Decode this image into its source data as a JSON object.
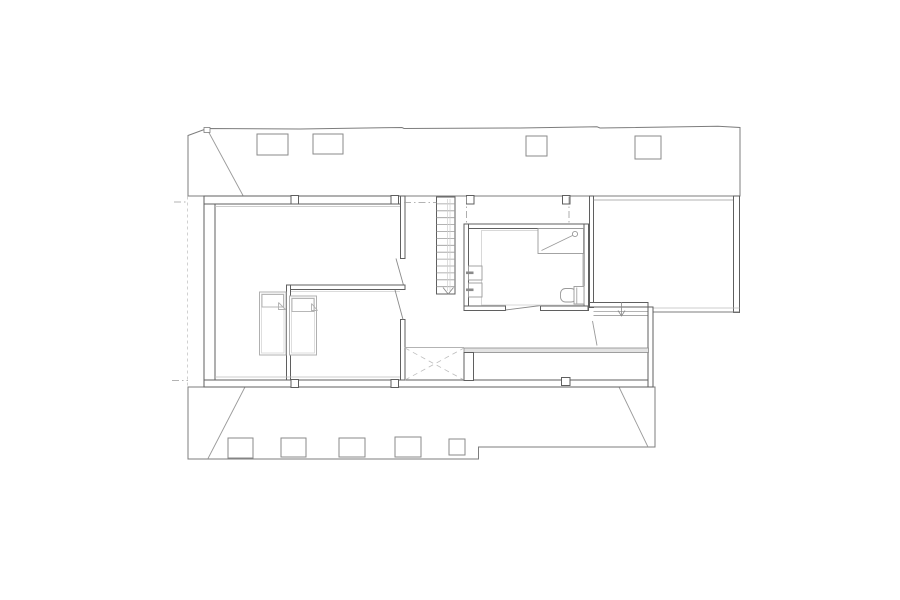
{
  "palette": {
    "wall": "#5f5f5f",
    "edge": "#7d7d7d",
    "line": "#9a9a9a",
    "mid": "#8a8a8a",
    "light": "#bdbdbd",
    "xlight": "#cfcfcf",
    "bed": "#b0b0b0",
    "bedin": "#d6d6d6",
    "dashln": "#c6c6c6",
    "glass": "#e3e3e3",
    "white": "#ffffff"
  },
  "canvas": {
    "width": 900,
    "height": 600,
    "background": "#ffffff"
  },
  "dash": {
    "dot": "3,3",
    "centerline": "7,3,1.5,3",
    "void": "5,4"
  },
  "shapes": [
    {
      "type": "poly",
      "name": "upper-roof-outline",
      "points": "188,135.5 207,128.5 300,129 402,127.5 404,128.5 520,128 597,126.8 600,128 718,126.3 740,127.5 740,196 188,196",
      "stroke": "edge",
      "fill": "white",
      "sw": 1
    },
    {
      "type": "line",
      "name": "upper-roof-hip",
      "x1": 207,
      "y1": 129,
      "x2": 243,
      "y2": 195.5,
      "stroke": "line",
      "sw": 0.9
    },
    {
      "type": "rect",
      "name": "upper-roof-step-notch",
      "x": 204,
      "y": 127.5,
      "w": 6,
      "h": 5,
      "stroke": "edge",
      "fill": "white",
      "sw": 0.8
    },
    {
      "type": "rect",
      "name": "skylight-upper-1",
      "x": 257,
      "y": 134,
      "w": 31,
      "h": 21,
      "stroke": "mid",
      "fill": "white",
      "sw": 1
    },
    {
      "type": "rect",
      "name": "skylight-upper-2",
      "x": 313,
      "y": 134,
      "w": 30,
      "h": 20,
      "stroke": "mid",
      "fill": "white",
      "sw": 1
    },
    {
      "type": "rect",
      "name": "skylight-upper-3",
      "x": 526,
      "y": 136,
      "w": 21,
      "h": 20,
      "stroke": "mid",
      "fill": "white",
      "sw": 1
    },
    {
      "type": "rect",
      "name": "skylight-upper-4",
      "x": 635,
      "y": 136,
      "w": 26,
      "h": 23,
      "stroke": "mid",
      "fill": "white",
      "sw": 1
    },
    {
      "type": "poly",
      "name": "lower-roof-outline",
      "points": "188,387 188,459 478.5,459 478.5,447 655,447 655,387",
      "stroke": "edge",
      "fill": "white",
      "sw": 1
    },
    {
      "type": "line",
      "name": "lower-roof-hip-left",
      "x1": 208,
      "y1": 458.5,
      "x2": 245,
      "y2": 387,
      "stroke": "line",
      "sw": 0.9
    },
    {
      "type": "line",
      "name": "lower-roof-hip-right",
      "x1": 619,
      "y1": 387,
      "x2": 648,
      "y2": 447,
      "stroke": "line",
      "sw": 0.9
    },
    {
      "type": "rect",
      "name": "skylight-lower-1",
      "x": 228,
      "y": 438,
      "w": 25,
      "h": 20,
      "stroke": "mid",
      "fill": "white",
      "sw": 1
    },
    {
      "type": "rect",
      "name": "skylight-lower-2",
      "x": 281,
      "y": 438,
      "w": 25,
      "h": 19,
      "stroke": "mid",
      "fill": "white",
      "sw": 1
    },
    {
      "type": "rect",
      "name": "skylight-lower-3",
      "x": 339,
      "y": 438,
      "w": 26,
      "h": 19,
      "stroke": "mid",
      "fill": "white",
      "sw": 1
    },
    {
      "type": "rect",
      "name": "skylight-lower-4",
      "x": 395,
      "y": 437,
      "w": 26,
      "h": 20,
      "stroke": "mid",
      "fill": "white",
      "sw": 1
    },
    {
      "type": "rect",
      "name": "skylight-lower-5",
      "x": 449,
      "y": 439,
      "w": 16,
      "h": 16,
      "stroke": "mid",
      "fill": "white",
      "sw": 1
    },
    {
      "type": "line",
      "name": "eave-projection-dashed",
      "x1": 187.5,
      "y1": 196.5,
      "x2": 187.5,
      "y2": 387,
      "stroke": "dashln",
      "sw": 0.8,
      "dash": "3,3"
    },
    {
      "type": "line",
      "name": "centerline-left-top",
      "x1": 174,
      "y1": 202,
      "x2": 188,
      "y2": 202,
      "stroke": "line",
      "sw": 0.8,
      "dash": "7,3,1.5,3"
    },
    {
      "type": "line",
      "name": "centerline-left-bottom",
      "x1": 172,
      "y1": 380.5,
      "x2": 188,
      "y2": 380.5,
      "stroke": "line",
      "sw": 0.8,
      "dash": "7,3,1.5,3"
    },
    {
      "type": "rect",
      "name": "left-exterior-wall",
      "x": 204,
      "y": 198.5,
      "w": 11,
      "h": 183,
      "stroke": "wall",
      "fill": "white",
      "sw": 1
    },
    {
      "type": "rect",
      "name": "top-exterior-wall",
      "x": 204,
      "y": 196,
      "w": 201,
      "h": 8,
      "stroke": "wall",
      "fill": "white",
      "sw": 1
    },
    {
      "type": "line",
      "name": "room1-top-finish-line",
      "x1": 215,
      "y1": 206.5,
      "x2": 400,
      "y2": 206.5,
      "stroke": "light",
      "sw": 0.8
    },
    {
      "type": "rect",
      "name": "room1-right-wall",
      "x": 400.5,
      "y": 196,
      "w": 4.5,
      "h": 62.5,
      "stroke": "wall",
      "fill": "white",
      "sw": 1
    },
    {
      "type": "line",
      "name": "room1-door-leaf",
      "x1": 396,
      "y1": 258.5,
      "x2": 404,
      "y2": 287,
      "stroke": "mid",
      "sw": 0.9
    },
    {
      "type": "rect",
      "name": "bedrooms-dividing-wall-horizontal",
      "x": 286.5,
      "y": 285,
      "w": 118.5,
      "h": 4.5,
      "stroke": "wall",
      "fill": "white",
      "sw": 1
    },
    {
      "type": "rect",
      "name": "bedrooms-dividing-wall-vertical",
      "x": 286.5,
      "y": 285,
      "w": 4,
      "h": 95.5,
      "stroke": "wall",
      "fill": "white",
      "sw": 1
    },
    {
      "type": "line",
      "name": "room2-top-finish-line",
      "x1": 291,
      "y1": 291.5,
      "x2": 400,
      "y2": 291.5,
      "stroke": "xlight",
      "sw": 0.8
    },
    {
      "type": "rect",
      "name": "room2-right-wall",
      "x": 400.5,
      "y": 319.5,
      "w": 4.5,
      "h": 60.5,
      "stroke": "wall",
      "fill": "white",
      "sw": 1
    },
    {
      "type": "line",
      "name": "room2-door-leaf",
      "x1": 395,
      "y1": 290,
      "x2": 403,
      "y2": 319.5,
      "stroke": "mid",
      "sw": 0.9
    },
    {
      "type": "line",
      "name": "rooms-bottom-finish-line",
      "x1": 215,
      "y1": 377,
      "x2": 400,
      "y2": 377,
      "stroke": "light",
      "sw": 0.8
    },
    {
      "type": "rect",
      "name": "bottom-exterior-wall",
      "x": 204,
      "y": 380,
      "w": 449,
      "h": 7,
      "stroke": "wall",
      "fill": "white",
      "sw": 1
    },
    {
      "type": "rect",
      "name": "column-post-top-1",
      "x": 291,
      "y": 195.5,
      "w": 7.5,
      "h": 8.5,
      "stroke": "wall",
      "fill": "white",
      "sw": 1
    },
    {
      "type": "rect",
      "name": "column-post-top-2",
      "x": 391,
      "y": 195.5,
      "w": 7.5,
      "h": 8.5,
      "stroke": "wall",
      "fill": "white",
      "sw": 1
    },
    {
      "type": "rect",
      "name": "column-post-skybox-left",
      "x": 466.5,
      "y": 195.5,
      "w": 7.5,
      "h": 8.5,
      "stroke": "wall",
      "fill": "white",
      "sw": 1
    },
    {
      "type": "rect",
      "name": "column-post-skybox-right",
      "x": 562.5,
      "y": 195.5,
      "w": 7.5,
      "h": 8.5,
      "stroke": "wall",
      "fill": "white",
      "sw": 1
    },
    {
      "type": "rect",
      "name": "column-post-bottom-1",
      "x": 291,
      "y": 379.5,
      "w": 7.5,
      "h": 8,
      "stroke": "wall",
      "fill": "white",
      "sw": 1
    },
    {
      "type": "rect",
      "name": "column-post-bottom-2",
      "x": 391,
      "y": 379.5,
      "w": 7.5,
      "h": 8,
      "stroke": "wall",
      "fill": "white",
      "sw": 1
    },
    {
      "type": "rect",
      "name": "column-post-bottom-3",
      "x": 561.5,
      "y": 377.5,
      "w": 8.5,
      "h": 8,
      "stroke": "wall",
      "fill": "white",
      "sw": 1
    },
    {
      "type": "rect",
      "name": "bed-1-outline",
      "x": 259.5,
      "y": 292,
      "w": 26.5,
      "h": 63,
      "stroke": "bed",
      "fill": "white",
      "sw": 1
    },
    {
      "type": "rect",
      "name": "bed-1-inner",
      "x": 261.5,
      "y": 294,
      "w": 22.5,
      "h": 59,
      "stroke": "bedin",
      "fill": "none",
      "sw": 0.8
    },
    {
      "type": "rect",
      "name": "bed-1-pillow",
      "x": 262,
      "y": 294.5,
      "w": 21.5,
      "h": 12.5,
      "stroke": "bed",
      "fill": "white",
      "sw": 0.9
    },
    {
      "type": "pline",
      "name": "bed-1-blanket-fold",
      "points": "278.5,302.5 278.5,309.5 285.5,309.5",
      "stroke": "bed",
      "fill": "none",
      "sw": 0.9
    },
    {
      "type": "line",
      "name": "bed-1-blanket-fold-diagonal",
      "x1": 278.5,
      "y1": 302.5,
      "x2": 285.5,
      "y2": 309.5,
      "stroke": "bed",
      "sw": 0.9
    },
    {
      "type": "rect",
      "name": "bed-2-outline",
      "x": 289.5,
      "y": 296,
      "w": 27,
      "h": 59,
      "stroke": "bed",
      "fill": "white",
      "sw": 1
    },
    {
      "type": "rect",
      "name": "bed-2-inner",
      "x": 291.5,
      "y": 298,
      "w": 23,
      "h": 55,
      "stroke": "bedin",
      "fill": "none",
      "sw": 0.8
    },
    {
      "type": "rect",
      "name": "bed-2-pillow",
      "x": 292,
      "y": 298.5,
      "w": 22,
      "h": 13,
      "stroke": "bed",
      "fill": "white",
      "sw": 0.9
    },
    {
      "type": "pline",
      "name": "bed-2-blanket-fold",
      "points": "311.5,303.5 311.5,310.5 317.5,310.5",
      "stroke": "bed",
      "fill": "none",
      "sw": 0.9
    },
    {
      "type": "line",
      "name": "bed-2-blanket-fold-diagonal",
      "x1": 311.5,
      "y1": 303.5,
      "x2": 317.5,
      "y2": 310.5,
      "stroke": "bed",
      "sw": 0.9
    },
    {
      "type": "rect",
      "name": "staircase-outline",
      "x": 436.5,
      "y": 197,
      "w": 18.5,
      "h": 97,
      "stroke": "wall",
      "fill": "white",
      "sw": 1
    },
    {
      "type": "hlines",
      "name": "staircase-treads",
      "x1": 436.5,
      "x2": 455,
      "y0": 203.9,
      "dy": 6.9,
      "n": 13,
      "stroke": "line",
      "sw": 0.8
    },
    {
      "type": "line",
      "name": "staircase-handrail-1",
      "x1": 447.5,
      "y1": 199,
      "x2": 447.5,
      "y2": 291,
      "stroke": "xlight",
      "sw": 0.7
    },
    {
      "type": "line",
      "name": "staircase-handrail-2",
      "x1": 450,
      "y1": 199,
      "x2": 450,
      "y2": 291,
      "stroke": "xlight",
      "sw": 0.7
    },
    {
      "type": "pline",
      "name": "staircase-down-arrow",
      "points": "443,287.5 448.2,294 453.5,287.5",
      "stroke": "mid",
      "fill": "none",
      "sw": 0.9
    },
    {
      "type": "line",
      "name": "centerline-hall",
      "x1": 404,
      "y1": 202.5,
      "x2": 436.5,
      "y2": 202.5,
      "stroke": "line",
      "sw": 0.8,
      "dash": "7,3,1.5,3"
    },
    {
      "type": "line",
      "name": "centerline-rooflight-left",
      "x1": 466.5,
      "y1": 196.5,
      "x2": 466.5,
      "y2": 224,
      "stroke": "line",
      "sw": 0.8,
      "dash": "7,3,1.5,3"
    },
    {
      "type": "line",
      "name": "centerline-rooflight-right",
      "x1": 569,
      "y1": 196.5,
      "x2": 569,
      "y2": 224,
      "stroke": "line",
      "sw": 0.8,
      "dash": "7,3,1.5,3"
    },
    {
      "type": "line",
      "name": "rooflight-bottom-edge",
      "x1": 464.5,
      "y1": 224,
      "x2": 572,
      "y2": 224,
      "stroke": "line",
      "sw": 0.9
    },
    {
      "type": "rect",
      "name": "bathroom-top-wall",
      "x": 464,
      "y": 224,
      "w": 124,
      "h": 4.5,
      "stroke": "wall",
      "fill": "white",
      "sw": 1
    },
    {
      "type": "rect",
      "name": "bathroom-left-wall",
      "x": 464,
      "y": 224,
      "w": 4.5,
      "h": 86.5,
      "stroke": "wall",
      "fill": "white",
      "sw": 1
    },
    {
      "type": "rect",
      "name": "bathroom-right-wall",
      "x": 584,
      "y": 224,
      "w": 4.5,
      "h": 86.5,
      "stroke": "wall",
      "fill": "white",
      "sw": 1
    },
    {
      "type": "rect",
      "name": "bathroom-bottom-wall-left",
      "x": 464,
      "y": 306,
      "w": 41.5,
      "h": 4.5,
      "stroke": "wall",
      "fill": "white",
      "sw": 1
    },
    {
      "type": "rect",
      "name": "bathroom-bottom-wall-right",
      "x": 540.5,
      "y": 306,
      "w": 47.5,
      "h": 4.5,
      "stroke": "wall",
      "fill": "white",
      "sw": 1
    },
    {
      "type": "line",
      "name": "bathroom-door-leaf",
      "x1": 505.5,
      "y1": 310,
      "x2": 541,
      "y2": 305.5,
      "stroke": "mid",
      "sw": 0.9
    },
    {
      "type": "rect",
      "name": "bathroom-finish-line",
      "x": 481.5,
      "y": 230.5,
      "w": 101,
      "h": 74.5,
      "stroke": "xlight",
      "fill": "none",
      "sw": 0.8
    },
    {
      "type": "rect",
      "name": "shower-tray",
      "x": 538,
      "y": 228.5,
      "w": 45.5,
      "h": 25,
      "stroke": "line",
      "fill": "white",
      "sw": 0.9
    },
    {
      "type": "line",
      "name": "shower-drain-diagonal",
      "x1": 541.5,
      "y1": 250.5,
      "x2": 572.5,
      "y2": 235.5,
      "stroke": "line",
      "sw": 0.8
    },
    {
      "type": "circle",
      "name": "shower-head",
      "cx": 575,
      "cy": 234,
      "r": 2.6,
      "stroke": "line",
      "fill": "none",
      "sw": 0.9
    },
    {
      "type": "rect",
      "name": "sink-1",
      "x": 468.5,
      "y": 266,
      "w": 13.5,
      "h": 14,
      "stroke": "line",
      "fill": "white",
      "sw": 0.9
    },
    {
      "type": "rect",
      "name": "sink-1-tap",
      "x": 466,
      "y": 271.5,
      "w": 7.5,
      "h": 2.6,
      "stroke": "none",
      "fill": "mid"
    },
    {
      "type": "rect",
      "name": "sink-2",
      "x": 468.5,
      "y": 283,
      "w": 13.5,
      "h": 14,
      "stroke": "line",
      "fill": "white",
      "sw": 0.9
    },
    {
      "type": "rect",
      "name": "sink-2-tap",
      "x": 466,
      "y": 288.5,
      "w": 7.5,
      "h": 2.6,
      "stroke": "none",
      "fill": "mid"
    },
    {
      "type": "rect",
      "name": "toilet-bowl",
      "x": 560.5,
      "y": 288.5,
      "w": 15.5,
      "h": 13.5,
      "rx": 5,
      "stroke": "line",
      "fill": "white",
      "sw": 0.9
    },
    {
      "type": "rect",
      "name": "toilet-cistern",
      "x": 574,
      "y": 286.5,
      "w": 10,
      "h": 17.5,
      "stroke": "line",
      "fill": "white",
      "sw": 0.9
    },
    {
      "type": "line",
      "name": "toilet-cistern-line",
      "x1": 576.8,
      "y1": 287.5,
      "x2": 576.8,
      "y2": 303.5,
      "stroke": "line",
      "sw": 0.8
    },
    {
      "type": "rect",
      "name": "right-room-left-wall",
      "x": 589.5,
      "y": 196,
      "w": 4,
      "h": 111.5,
      "stroke": "wall",
      "fill": "white",
      "sw": 1
    },
    {
      "type": "line",
      "name": "right-room-top-finish-line",
      "x1": 593.5,
      "y1": 200,
      "x2": 733.5,
      "y2": 200,
      "stroke": "line",
      "sw": 0.8
    },
    {
      "type": "rect",
      "name": "right-room-right-wall",
      "x": 733.5,
      "y": 196,
      "w": 6,
      "h": 116.5,
      "stroke": "wall",
      "fill": "white",
      "sw": 1
    },
    {
      "type": "rect",
      "name": "right-room-bottom-wall",
      "x": 589.5,
      "y": 302.5,
      "w": 58.5,
      "h": 4.5,
      "stroke": "wall",
      "fill": "white",
      "sw": 1
    },
    {
      "type": "line",
      "name": "right-step-edge-1",
      "x1": 593.5,
      "y1": 311.5,
      "x2": 648,
      "y2": 311.5,
      "stroke": "line",
      "sw": 0.8
    },
    {
      "type": "line",
      "name": "right-step-edge-2",
      "x1": 593.5,
      "y1": 315.5,
      "x2": 648,
      "y2": 315.5,
      "stroke": "mid",
      "sw": 0.8
    },
    {
      "type": "line",
      "name": "right-outer-edge-1",
      "x1": 653,
      "y1": 308,
      "x2": 739.5,
      "y2": 308,
      "stroke": "light",
      "sw": 0.8
    },
    {
      "type": "line",
      "name": "right-outer-edge-2",
      "x1": 653,
      "y1": 312,
      "x2": 739.5,
      "y2": 312,
      "stroke": "edge",
      "sw": 0.9
    },
    {
      "type": "rect",
      "name": "right-lower-wall",
      "x": 648,
      "y": 307,
      "w": 5,
      "h": 80,
      "stroke": "wall",
      "fill": "white",
      "sw": 1
    },
    {
      "type": "line",
      "name": "right-step-arrow-stem",
      "x1": 621.5,
      "y1": 302,
      "x2": 621.5,
      "y2": 315,
      "stroke": "mid",
      "sw": 0.8
    },
    {
      "type": "pline",
      "name": "right-step-arrow-head",
      "points": "618,310.5 621.5,316 625,310.5",
      "stroke": "mid",
      "fill": "none",
      "sw": 0.8
    },
    {
      "type": "line",
      "name": "right-door-leaf",
      "x1": 592.5,
      "y1": 321,
      "x2": 597,
      "y2": 345.5,
      "stroke": "line",
      "sw": 0.9
    },
    {
      "type": "rect",
      "name": "glazed-wall-band",
      "x": 464,
      "y": 348,
      "w": 184.5,
      "h": 4.5,
      "stroke": "mid",
      "fill": "glass",
      "sw": 0.8
    },
    {
      "type": "line",
      "name": "void-top-edge",
      "x1": 404.5,
      "y1": 347.5,
      "x2": 464,
      "y2": 347.5,
      "stroke": "line",
      "sw": 0.8
    },
    {
      "type": "line",
      "name": "void-cross-diagonal-1",
      "x1": 405,
      "y1": 348,
      "x2": 464,
      "y2": 380,
      "stroke": "light",
      "sw": 0.8,
      "dash": "5,4"
    },
    {
      "type": "line",
      "name": "void-cross-diagonal-2",
      "x1": 405,
      "y1": 380,
      "x2": 464,
      "y2": 348,
      "stroke": "light",
      "sw": 0.8,
      "dash": "5,4"
    },
    {
      "type": "rect",
      "name": "void-right-wall-stub",
      "x": 464,
      "y": 352.5,
      "w": 9.5,
      "h": 28,
      "stroke": "wall",
      "fill": "white",
      "sw": 1
    }
  ]
}
